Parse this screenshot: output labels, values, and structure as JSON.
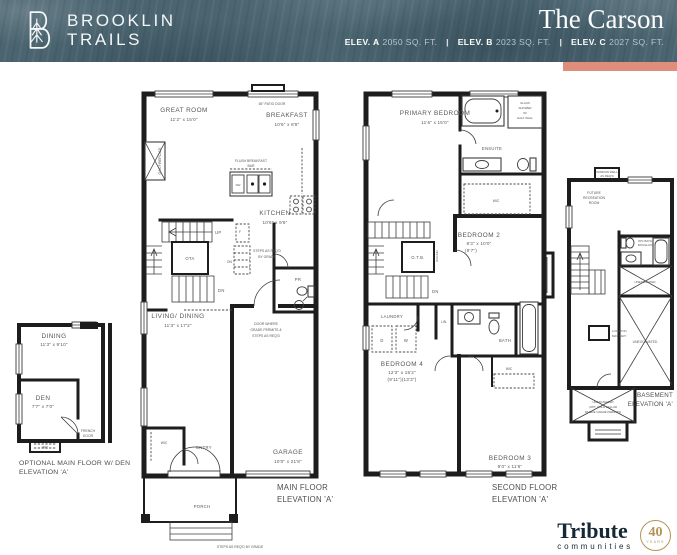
{
  "header": {
    "logo_line1": "BROOKLIN",
    "logo_line2": "TRAILS",
    "title": "The Carson",
    "elev_a_label": "ELEV. A",
    "elev_a_value": "2050 SQ. FT.",
    "elev_b_label": "ELEV. B",
    "elev_b_value": "2023 SQ. FT.",
    "elev_c_label": "ELEV. C",
    "elev_c_value": "2027 SQ. FT.",
    "separator": "|"
  },
  "main_floor": {
    "great_room": "GREAT ROOM",
    "great_room_dims": "11'2\" x 15'0\"",
    "patio_door": "65\" PATIO DOOR",
    "breakfast": "BREAKFAST",
    "breakfast_dims": "10'6\" x 8'8\"",
    "gas_fireplace": "GAS FIREPLACE",
    "flush_bar_1": "FLUSH BREAKFAST",
    "flush_bar_2": "BAR",
    "dw": "DW",
    "kitchen": "KITCHEN",
    "kitchen_dims": "10'6\" x 9'6\"",
    "fridge": "F",
    "up": "UP",
    "ota": "OTA",
    "dn": "DN",
    "dn2": "DN",
    "steps_1": "STEPS AS REQ'D",
    "steps_2": "BY GRADE",
    "pr": "PR",
    "living_dining": "LIVING/ DINING",
    "living_dining_dims": "11'3\" x 17'2\"",
    "door_grade_1": "DOOR WHERE",
    "door_grade_2": "GRADE PERMITS &",
    "door_grade_3": "STEPS AS REQ'D",
    "wic": "WIC",
    "entry": "ENTRY",
    "garage": "GARAGE",
    "garage_dims": "10'0\" x 21'8\"",
    "porch": "PORCH",
    "steps_bottom": "STEPS AS REQ'D BY GRADE",
    "caption_1": "MAIN FLOOR",
    "caption_2": "ELEVATION 'A'"
  },
  "second_floor": {
    "primary": "PRIMARY BEDROOM",
    "primary_dims": "11'6\" x 15'0\"",
    "shower_1": "GLASS",
    "shower_2": "SHOWER",
    "shower_3": "W/",
    "shower_4": "HALF WALL",
    "ensuite": "ENSUITE",
    "wic1": "WIC",
    "otb": "O.T.B.",
    "railing": "RAILING",
    "dn": "DN",
    "bedroom2": "BEDROOM 2",
    "bedroom2_dims": "8'3\" x 10'0\"",
    "bedroom2_dims2": "(9'7\")",
    "laundry": "LAUNDRY",
    "d": "D",
    "w": "W",
    "lin": "LIN.",
    "bath": "BATH",
    "bedroom4": "BEDROOM 4",
    "bedroom4_dims": "12'3\" x 15'2\"",
    "bedroom4_dims2": "(9'11\")(13'3\")",
    "wic2": "WIC",
    "bedroom3": "BEDROOM 3",
    "bedroom3_dims": "9'0\" x 11'6\"",
    "caption_1": "SECOND FLOOR",
    "caption_2": "ELEVATION 'A'"
  },
  "optional_floor": {
    "dining": "DINING",
    "dining_dims": "11'3\" x 9'10\"",
    "den": "DEN",
    "den_dims": "7'7\" x 7'0\"",
    "french_1": "FRENCH",
    "french_2": "DOOR",
    "wic": "WIC",
    "caption_1": "OPTIONAL MAIN FLOOR W/ DEN",
    "caption_2": "ELEVATION 'A'"
  },
  "basement": {
    "window_well_1": "WINDOW WELL",
    "window_well_2": "AS REQ'D",
    "future_1": "FUTURE",
    "future_2": "RECREATION",
    "future_3": "ROOM",
    "bath_1": "3PC BATH",
    "bath_2": "ROUGH-IN",
    "unexc_small": "UNEXCAVATED",
    "location_1": "LOCATION",
    "location_2": "MAY VARY",
    "unexcavated": "UNEXCAVATED",
    "cold_1": "UNEXCAVATED",
    "cold_2": "(OPT. COLD CELLAR",
    "cold_3": "WHERE GRADE PERMITS)",
    "caption_1": "BASEMENT",
    "caption_2": "ELEVATION 'A'"
  },
  "footer": {
    "brand": "Tribute",
    "brand_sub": "communities",
    "seal_number": "40",
    "seal_label": "YEARS"
  },
  "colors": {
    "header_bg": "#4a6470",
    "accent_bar": "#e18d7b",
    "wall": "#1d1d1d",
    "label": "#575757",
    "brand_navy": "#152836",
    "seal_gold": "#b59455"
  }
}
